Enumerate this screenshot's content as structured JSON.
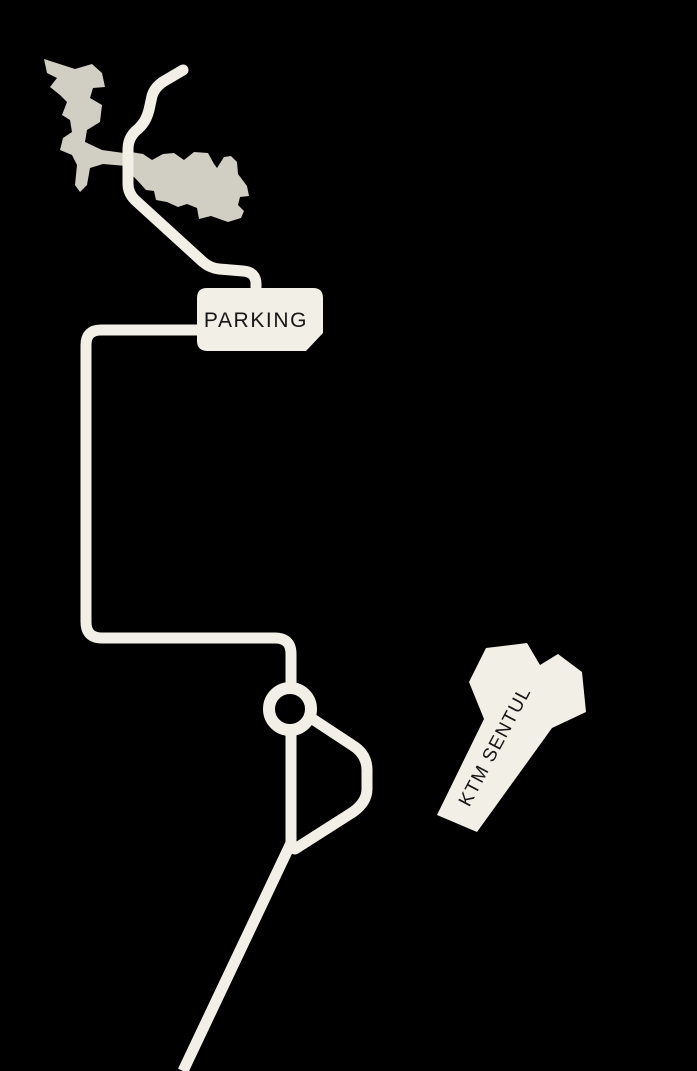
{
  "map": {
    "background_color": "#000000",
    "road_color": "#F2EFE6",
    "terrain_color": "#D1CEC3",
    "label_color": "#161616",
    "labels": {
      "parking": "PARKING",
      "station": "KTM SENTUL"
    }
  }
}
